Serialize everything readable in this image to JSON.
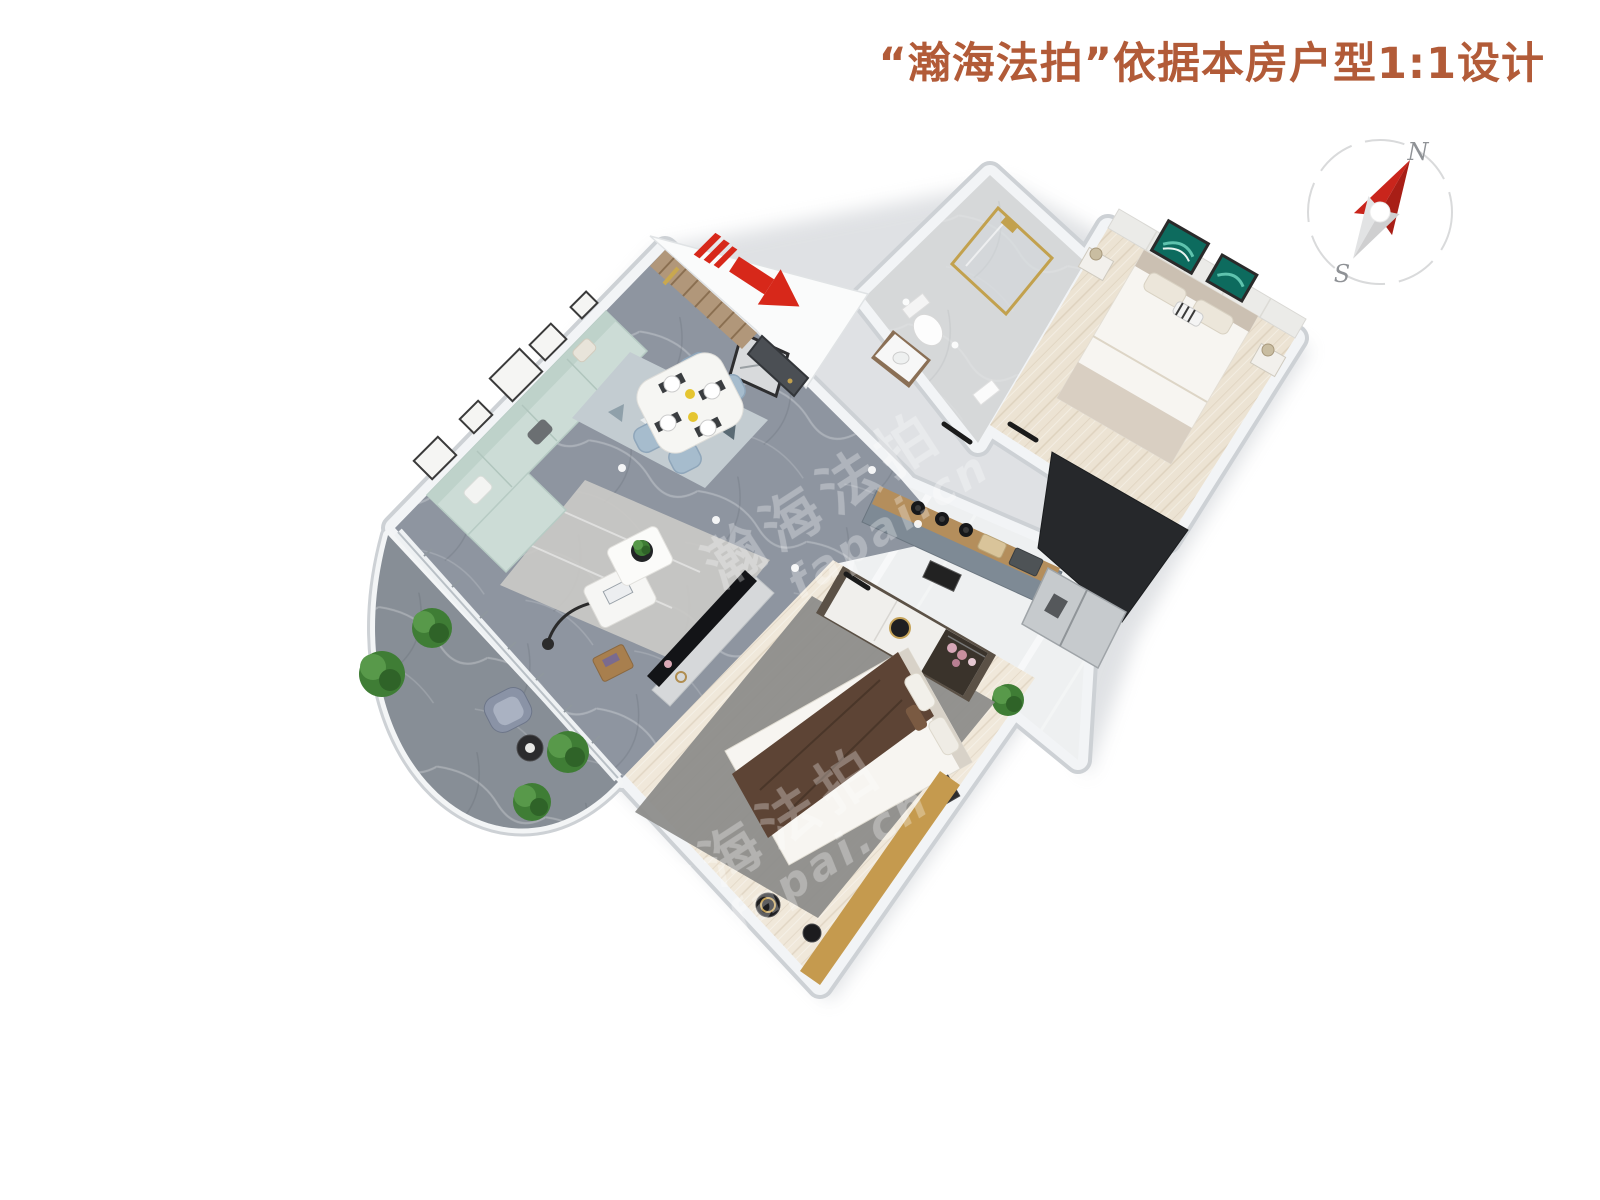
{
  "header": {
    "title": "“瀚海法拍”依据本房户型1:1设计",
    "title_color": "#b25b38"
  },
  "compass": {
    "north_label": "N",
    "south_label": "S",
    "needle_north_color": "#c9251c",
    "needle_north_dark": "#a81e16",
    "needle_south_color": "#e2e3e4",
    "ring_color": "#d9dadb",
    "label_color": "#8f9296"
  },
  "entrance": {
    "arrow_color": "#d7281a"
  },
  "watermark": {
    "line_cn": "瀚海法拍",
    "line_en": "fapai.cn",
    "color": "#ffffff"
  },
  "floors": {
    "living_marble": "#8e95a0",
    "balcony_marble": "#878e96",
    "bath_tile": "#d6d8d9",
    "bedroom1_wood": "#ece3d3",
    "kitchen_gloss": "#eef0f1",
    "bedroom2_wood": "#f0e8da"
  },
  "furniture": {
    "sofa": "#ccdcd6",
    "dining_chair": "#a6bccd",
    "living_rug": "#cac9c5",
    "dining_rug": "#c3ccd1",
    "bedroom2_rug": "#8d8d8b",
    "bed_duvet": "#f7f5f1",
    "bed_foot_beige": "#d9cfc2",
    "bed_blanket_brown": "#5d4435",
    "wardrobe_wood": "#5b5146",
    "counter_wood": "#b48e5c",
    "cabinet_gray": "#7e8a95",
    "fridge_steel": "#c6cacd",
    "gold": "#c2a14e",
    "plant_green": "#3f7d35",
    "tv_screen": "#131417",
    "wall_white": "#f2f4f6",
    "wall_edge": "#cdd1d5",
    "wood_bench": "#c59a4e",
    "door_dark": "#4b4f54"
  }
}
